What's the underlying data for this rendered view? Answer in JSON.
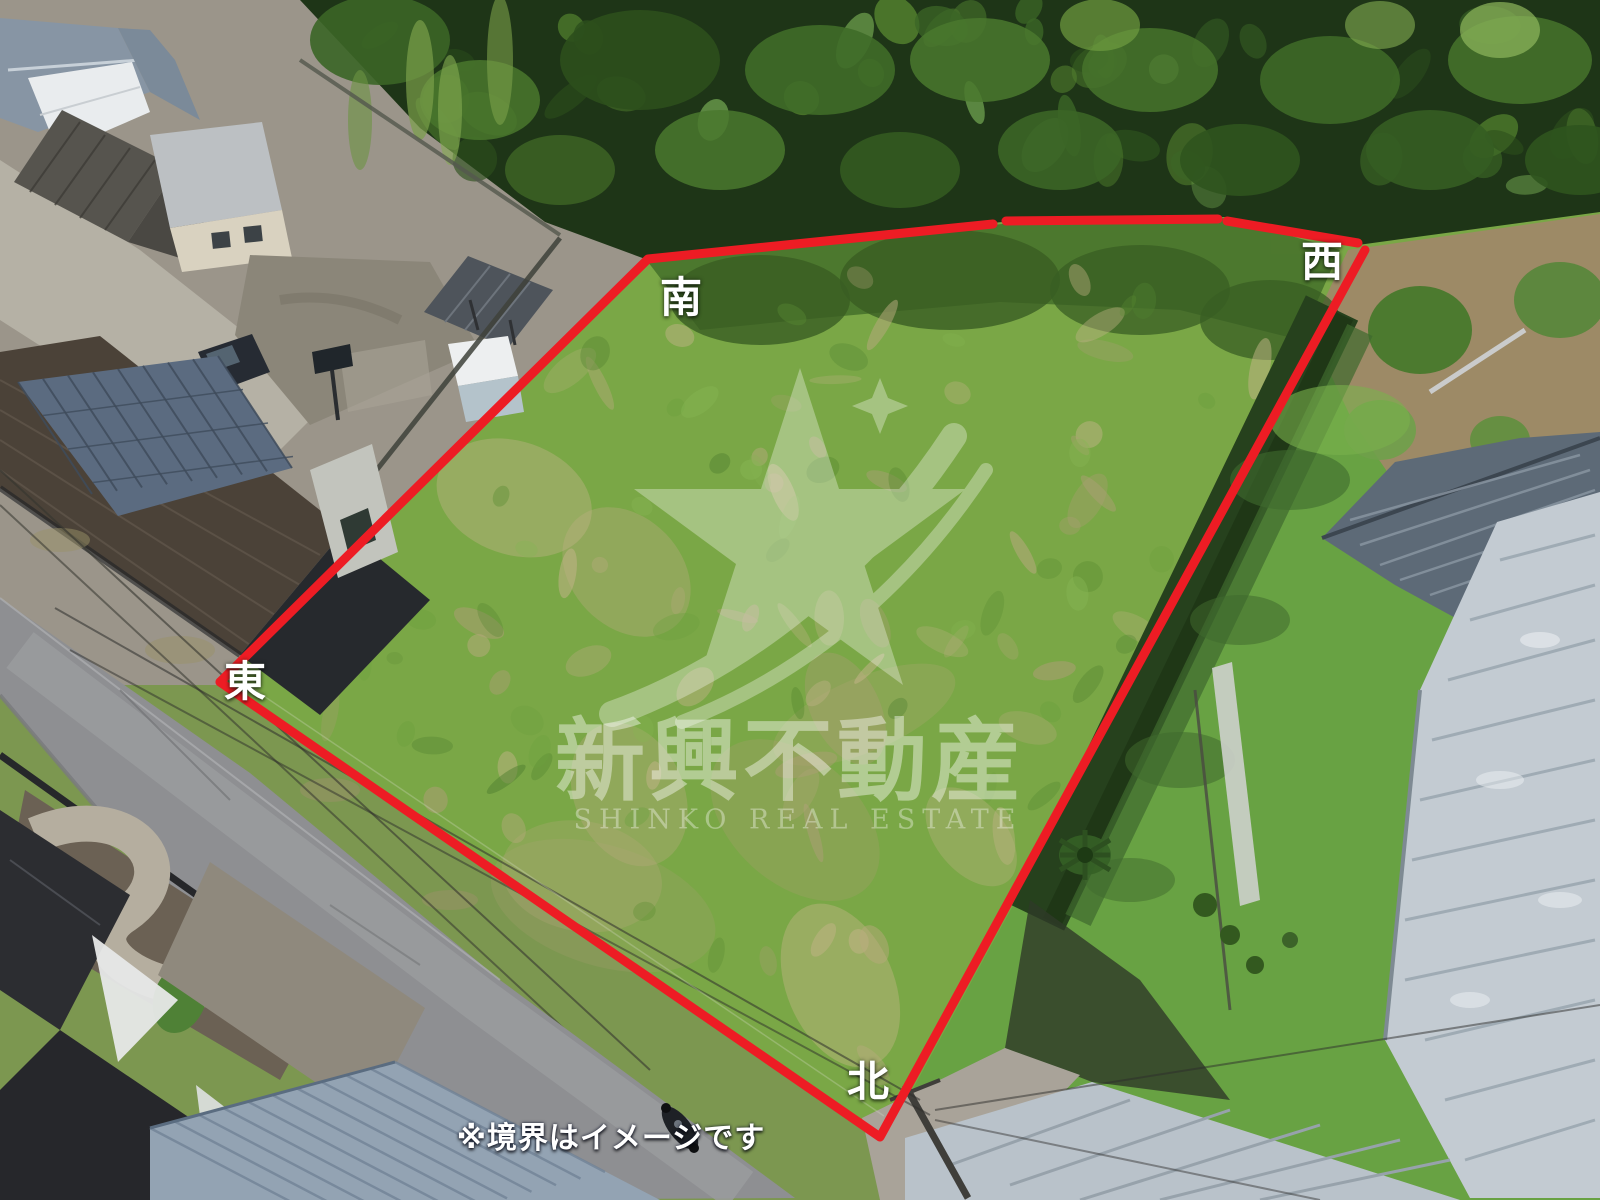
{
  "overlay": {
    "boundary_color": "#ed1c24",
    "labels": {
      "south": "南",
      "west": "西",
      "east": "東",
      "north": "北"
    },
    "disclaimer": "※境界はイメージです"
  },
  "watermark": {
    "logo_icon": "star-swoosh-logo",
    "company_name_jp": "新興不動産",
    "company_name_en": "SHINKO REAL ESTATE"
  }
}
